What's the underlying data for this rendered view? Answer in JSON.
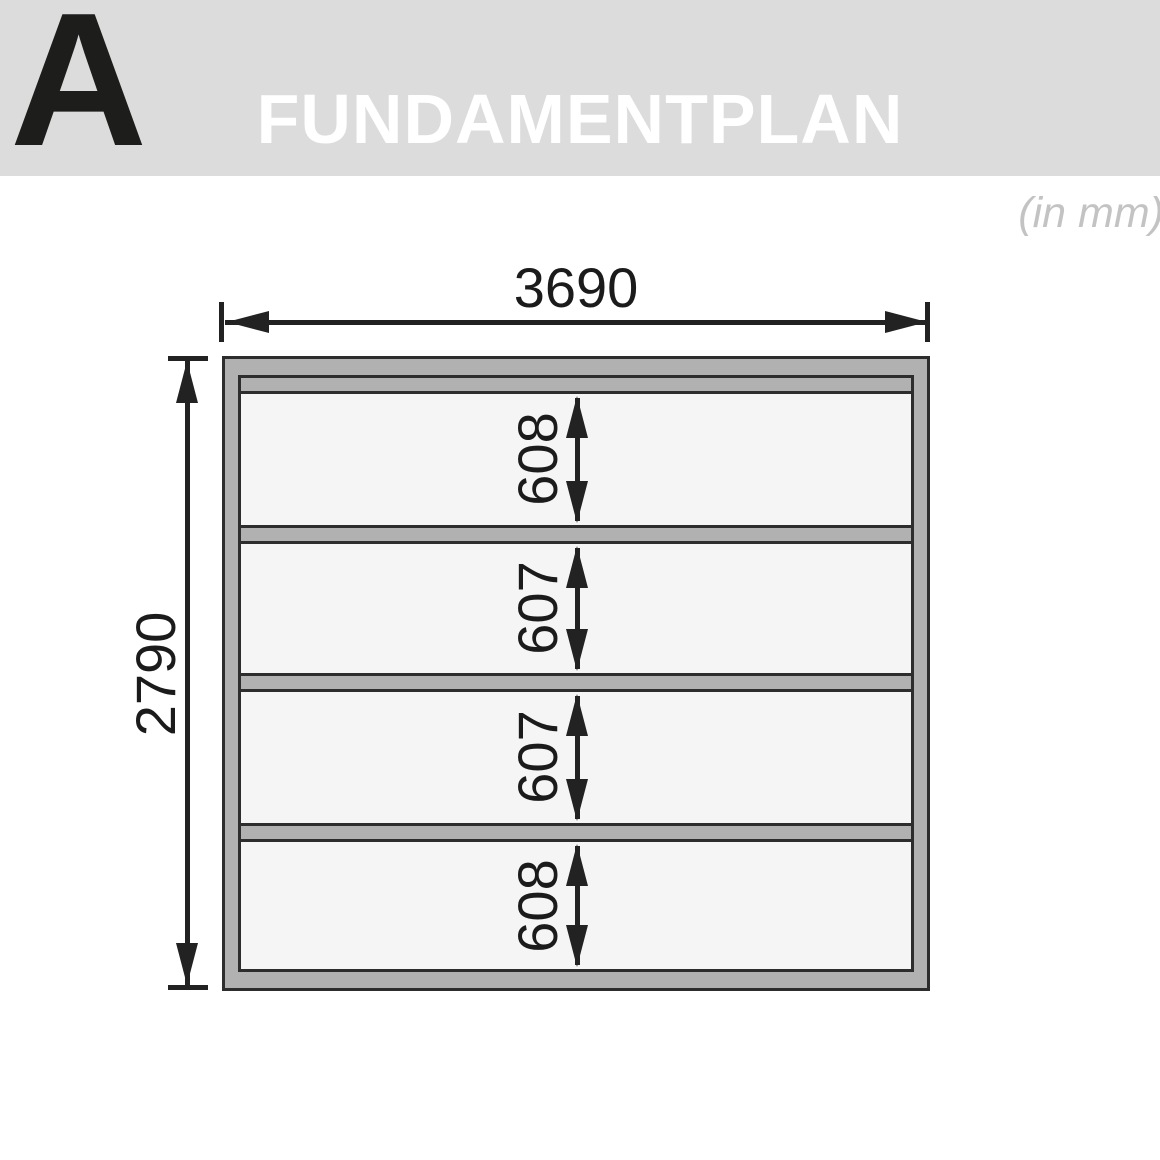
{
  "header": {
    "section_letter": "A",
    "title": "FUNDAMENTPLAN"
  },
  "units_note": "(in mm)",
  "diagram": {
    "type": "foundation-plan",
    "total_width_label": "3690",
    "total_height_label": "2790",
    "spacing_labels": [
      "608",
      "607",
      "607",
      "608"
    ],
    "total_width_mm": 3690,
    "total_height_mm": 2790,
    "spacings_mm": [
      608,
      607,
      607,
      608
    ],
    "horizontal_beams": 6,
    "side_rails": 2
  },
  "colors": {
    "banner_bg": "#dcdcdc",
    "banner_title": "#ffffff",
    "section_letter": "#1d1d1b",
    "units_note": "#c3c3c3",
    "beam_fill": "#b1b1b1",
    "plan_interior": "#f5f5f5",
    "outline": "#2d2d2d",
    "dimension_lines": "#222222"
  }
}
